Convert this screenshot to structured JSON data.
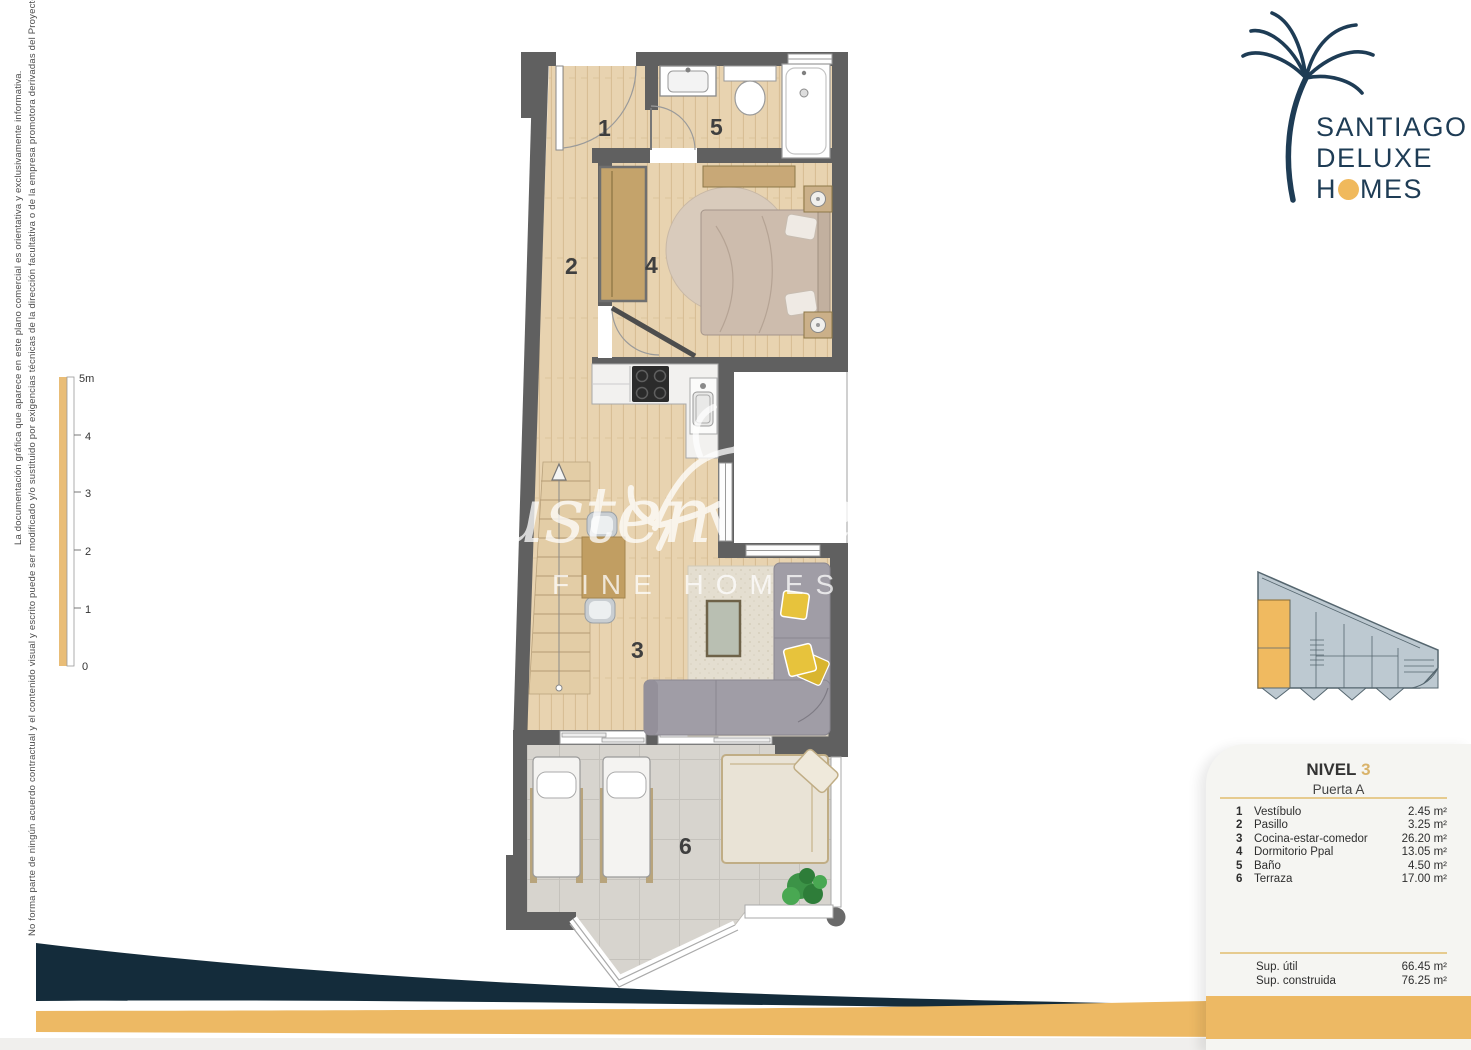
{
  "logo": {
    "line1": "SANTIAGO",
    "line2": "DELUXE",
    "line3_pre": "H",
    "line3_post": "MES"
  },
  "disclaimer": {
    "line1": "La documentación gráfica que aparece en este plano comercial es orientativa y exclusivamente informativa.",
    "line2": "No forma parte de ningún acuerdo contractual y el contenido visual y escrito puede ser modificado y/o sustituido por exigencias técnicas de la dirección facultativa o de la empresa promotora derivadas del Proyecto de Edificación y su ejecución."
  },
  "scale": {
    "labels": [
      "5m",
      "4",
      "3",
      "2",
      "1",
      "0"
    ]
  },
  "watermark": {
    "script1": "Austen",
    "script2": "Realty",
    "subtitle": "FINE HOMES & VILLAS"
  },
  "plan": {
    "labels": [
      "1",
      "2",
      "3",
      "4",
      "5",
      "6"
    ]
  },
  "legend": {
    "level_label": "NIVEL",
    "level_number": "3",
    "door": "Puerta A",
    "rows": [
      {
        "num": "1",
        "name": "Vestíbulo",
        "area": "2.45 m²"
      },
      {
        "num": "2",
        "name": "Pasillo",
        "area": "3.25 m²"
      },
      {
        "num": "3",
        "name": "Cocina-estar-comedor",
        "area": "26.20 m²"
      },
      {
        "num": "4",
        "name": "Dormitorio Ppal",
        "area": "13.05 m²"
      },
      {
        "num": "5",
        "name": "Baño",
        "area": "4.50 m²"
      },
      {
        "num": "6",
        "name": "Terraza",
        "area": "17.00 m²"
      }
    ],
    "totals": [
      {
        "name": "Sup. útil",
        "area": "66.45 m²"
      },
      {
        "name": "Sup. construida",
        "area": "76.25 m²"
      }
    ]
  },
  "colors": {
    "accent_orange": "#edb964",
    "navy": "#142c3b",
    "logo_navy": "#1e3c55",
    "wall_grey": "#606060"
  }
}
